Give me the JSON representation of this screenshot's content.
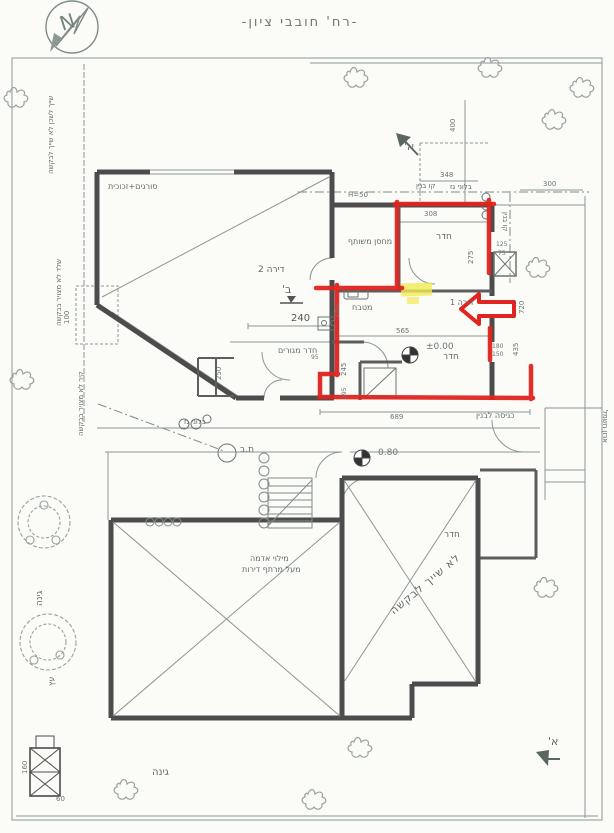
{
  "title": {
    "street": "-רח' חובבי ציון-"
  },
  "compass": {
    "letter": "N"
  },
  "apartments": {
    "apt1": "דירה 1",
    "apt2": "דירה 2"
  },
  "rooms": {
    "storage": "מחסן משותף",
    "room_top": "חדר",
    "room_mid": "חדר",
    "room_lower": "חדר",
    "kitchen": "מטבח",
    "living": "חדר מגורים"
  },
  "site": {
    "entrance": "כניסה לבנין",
    "gas1": "בלוני גז",
    "gas2": "בלוני גז",
    "building_line1": "קו בנין",
    "building_line2": "קו בנין",
    "manhole": "ת.ב",
    "garden1": "גינה",
    "garden2": "גינה",
    "tree": "עץ",
    "cabinet": "ארון חשמל"
  },
  "notes": {
    "bars": "סורגים+זכוכית",
    "left_top": "שייך לשכן לא שייך לבקשה",
    "left_mid": "שלד לא מצויר בבקשה",
    "left_low": "קיר לא מצויר בבקשה",
    "fill1": "מילוי אדמה",
    "fill2": "מעל מרתף דירות",
    "excluded": "לא שייך לבקשה",
    "parapet": "H=50"
  },
  "levels": {
    "zero": "±0.00",
    "l080": "0.80"
  },
  "sections": {
    "a1": "א'",
    "a2": "א'",
    "b": "ב'"
  },
  "dims": {
    "d400": "400",
    "d348": "348",
    "d300": "300",
    "d308": "308",
    "d275": "275",
    "d125": "125",
    "d75": "75",
    "d240": "240",
    "d150k": "150",
    "d565": "565",
    "d245": "245",
    "d295": "295",
    "d689": "689",
    "d720": "720",
    "d435": "435",
    "d180": "180",
    "d150r": "150",
    "d95": "95",
    "d100": "100",
    "d250": "250",
    "d160": "160",
    "d60": "60"
  },
  "colors": {
    "annotation_red": "#e0241f",
    "highlight_yellow": "#f2ea55",
    "wall_dark": "#4c4c4c",
    "line_gray": "#8a9793"
  }
}
